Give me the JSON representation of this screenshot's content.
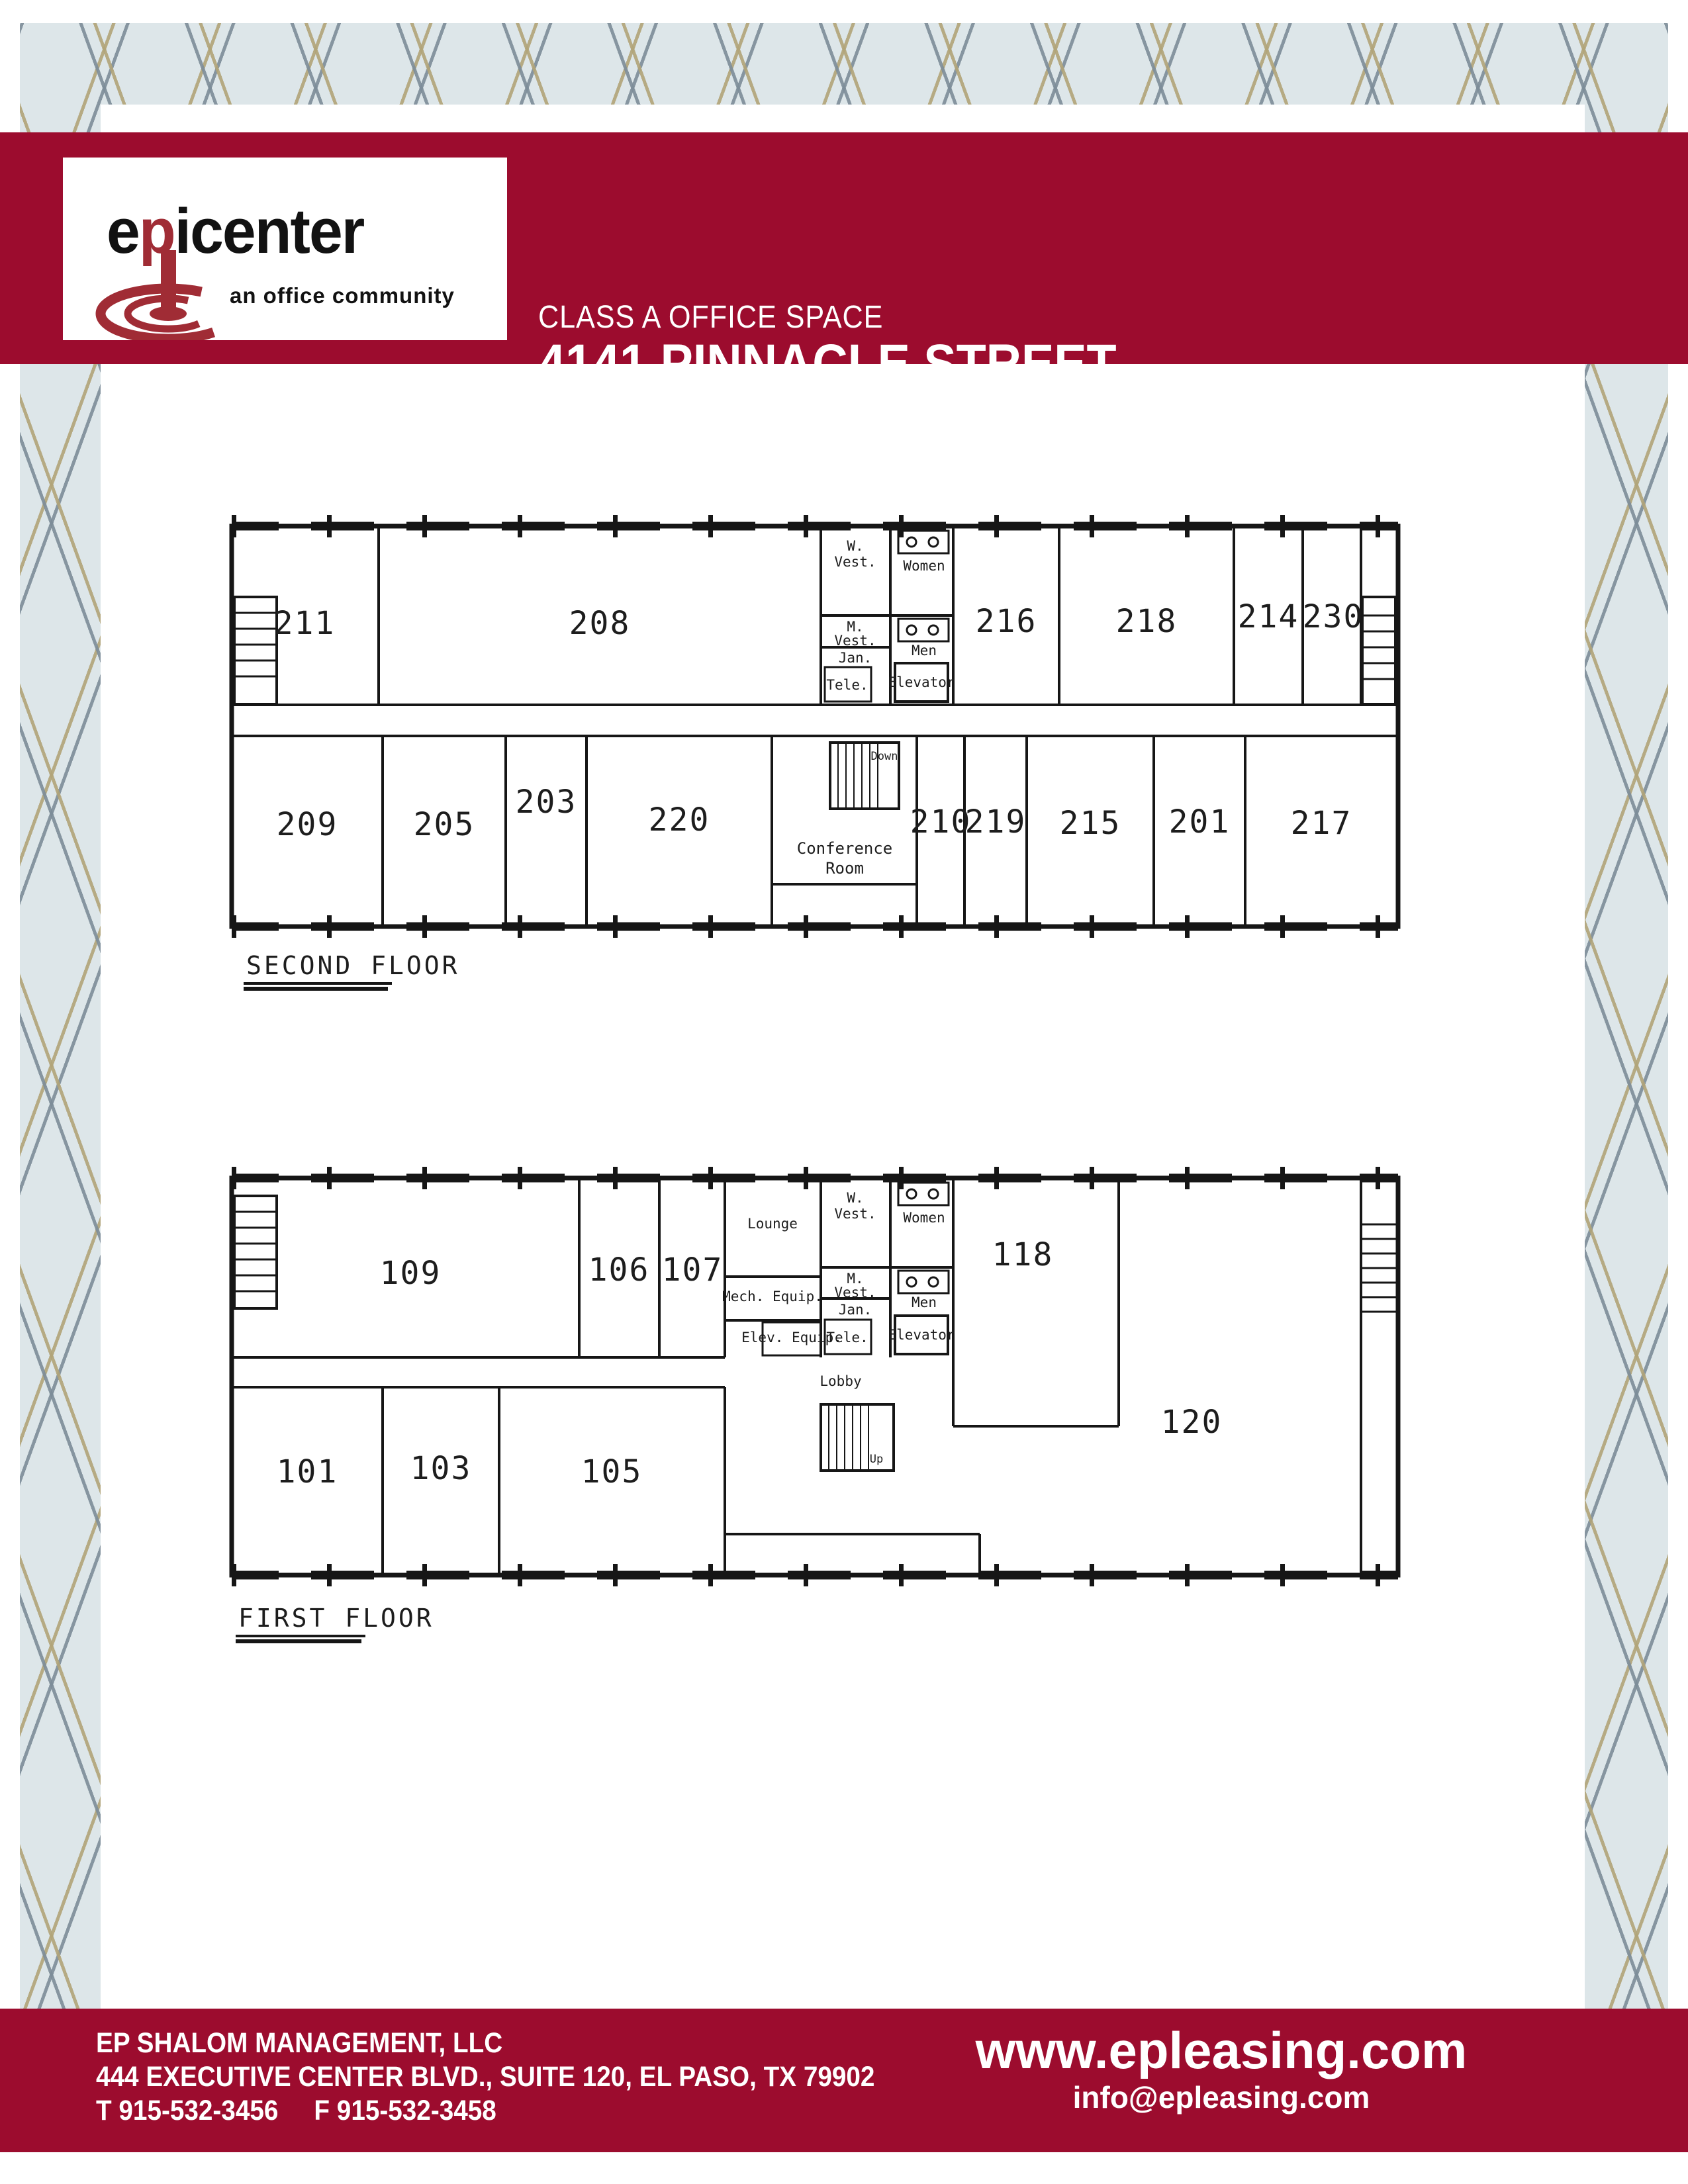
{
  "header": {
    "line1": "CLASS A OFFICE SPACE",
    "line2": "4141 PINNACLE STREET",
    "line3": "EL PASO-WEST/CENTRAL"
  },
  "logo": {
    "e": "e",
    "p": "p",
    "rest": "icenter",
    "tagline": "an office community"
  },
  "floors": {
    "second": {
      "title": "SECOND FLOOR",
      "rooms": {
        "r211": "211",
        "r208": "208",
        "r216": "216",
        "r218": "218",
        "r214": "214",
        "r230": "230",
        "r209": "209",
        "r205": "205",
        "r203": "203",
        "r220": "220",
        "r210": "210",
        "r219": "219",
        "r215": "215",
        "r201": "201",
        "r217": "217"
      },
      "labels": {
        "conference1": "Conference",
        "conference2": "Room",
        "down": "Down"
      }
    },
    "first": {
      "title": "FIRST FLOOR",
      "rooms": {
        "r109": "109",
        "r106": "106",
        "r107": "107",
        "r118": "118",
        "r120": "120",
        "r101": "101",
        "r103": "103",
        "r105": "105"
      },
      "labels": {
        "lounge": "Lounge",
        "mech": "Mech. Equip.",
        "elev_equip": "Elev. Equip.",
        "lobby": "Lobby",
        "up": "Up"
      }
    }
  },
  "core": {
    "w": "W.",
    "vest": "Vest.",
    "women": "Women",
    "m": "M.",
    "men": "Men",
    "jan": "Jan.",
    "tele": "Tele.",
    "elevator": "Elevator"
  },
  "footer": {
    "company": "EP SHALOM MANAGEMENT, LLC",
    "address": "444 EXECUTIVE CENTER BLVD., SUITE 120, EL PASO, TX 79902",
    "phone_t": "T 915-532-3456",
    "phone_f": "F 915-532-3458",
    "website": "www.epleasing.com",
    "email": "info@epleasing.com"
  },
  "colors": {
    "maroon": "#9c0c2e",
    "logo_red": "#a02c35",
    "pattern_bg": "#dde6e9"
  }
}
